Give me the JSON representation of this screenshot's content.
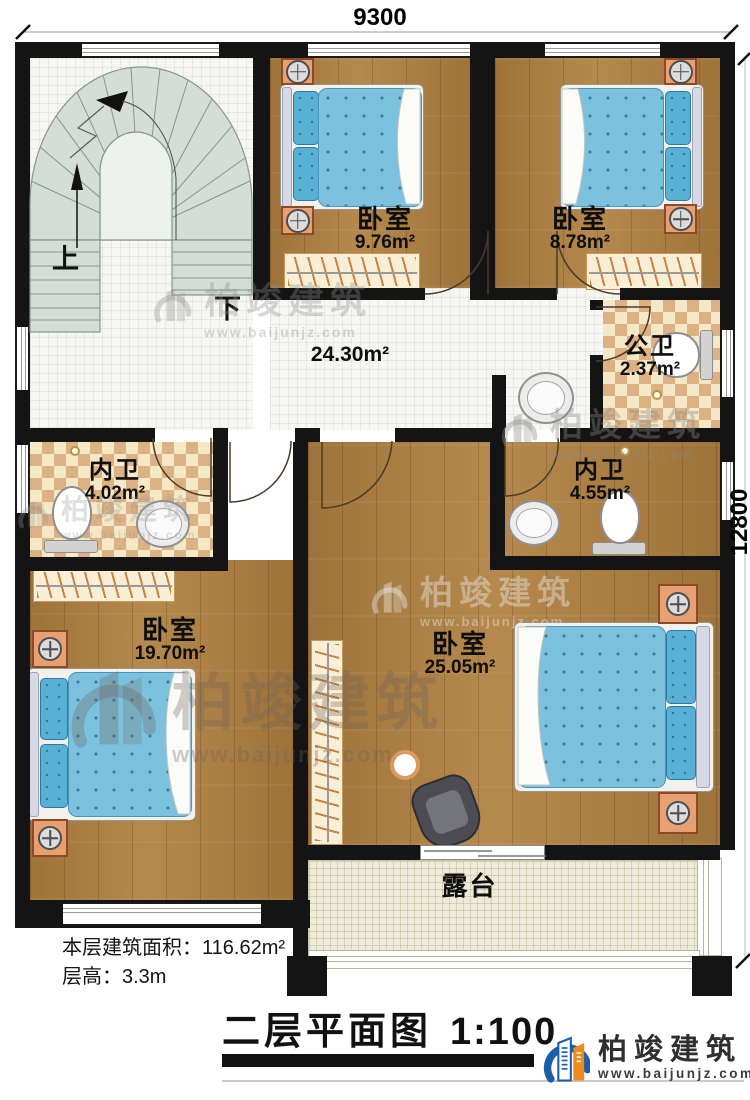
{
  "dimensions": {
    "top": "9300",
    "right": "12800"
  },
  "stairs": {
    "up": "上",
    "down": "下"
  },
  "rooms": [
    {
      "id": "bedroom-1",
      "name": "卧室",
      "area": "9.76m²"
    },
    {
      "id": "bedroom-2",
      "name": "卧室",
      "area": "8.78m²"
    },
    {
      "id": "hall",
      "name": "",
      "area": "24.30m²"
    },
    {
      "id": "public-bath",
      "name": "公卫",
      "area": "2.37m²"
    },
    {
      "id": "ensuite-left",
      "name": "内卫",
      "area": "4.02m²"
    },
    {
      "id": "ensuite-right",
      "name": "内卫",
      "area": "4.55m²"
    },
    {
      "id": "bedroom-3",
      "name": "卧室",
      "area": "19.70m²"
    },
    {
      "id": "bedroom-4",
      "name": "卧室",
      "area": "25.05m²"
    },
    {
      "id": "terrace",
      "name": "露台",
      "area": ""
    }
  ],
  "info": {
    "floor_area_label": "本层建筑面积：",
    "floor_area_value": "116.62m²",
    "height_label": "层高：",
    "height_value": "3.3m"
  },
  "title": {
    "text": "二层平面图",
    "scale": "1:100"
  },
  "brand": {
    "name": "柏竣建筑",
    "url": "www.baijunjz.com"
  },
  "watermark": {
    "name": "柏竣建筑",
    "url": "www.baijunjz.com"
  },
  "colors": {
    "wall": "#141414",
    "wood": "#b08040",
    "tile": "#f6f6f3",
    "checker": "#dcb184",
    "stair": "#d4ded7",
    "bed": "#7cc2de",
    "nightstand": "#e6a071",
    "terrace": "#edead9",
    "brand_blue": "#1b5ea9",
    "brand_orange": "#f08a1d"
  }
}
